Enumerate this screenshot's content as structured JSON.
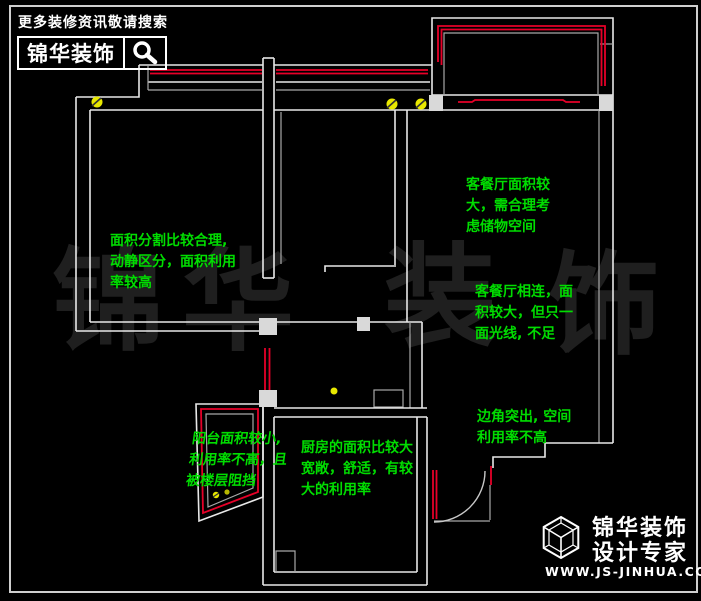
{
  "colors": {
    "background": "#000000",
    "wall_white": "#e8e8e8",
    "wall_gray": "#a8a8a8",
    "window_red": "#e60028",
    "annotation_green": "#00dd00",
    "symbol_yellow": "#e8e800",
    "watermark_gray": "#1f1f1f",
    "text_white": "#ffffff"
  },
  "header": {
    "slogan": "更多装修资讯敬请搜索",
    "brand": "锦华装饰"
  },
  "watermark": {
    "chars": [
      "锦",
      "华",
      "装",
      "饰"
    ]
  },
  "annotations": {
    "left_room": {
      "lines": [
        "面积分割比较合理,",
        "动静区分，面积利用",
        "率较高"
      ]
    },
    "living_top": {
      "lines": [
        "客餐厅面积较",
        "大，需合理考",
        "虑储物空间"
      ]
    },
    "living_mid": {
      "lines": [
        "客餐厅相连，面",
        "积较大，但只一",
        "面光线, 不足"
      ]
    },
    "corner": {
      "lines": [
        "边角突出, 空间",
        "利用率不高"
      ]
    },
    "balcony": {
      "lines": [
        "阳台面积较小,",
        "利用率不高，且",
        "被楼层阻挡"
      ]
    },
    "kitchen": {
      "lines": [
        "厨房的面积比较大",
        "宽敞，舒适，有较",
        "大的利用率"
      ]
    }
  },
  "footer": {
    "brand_line1": "锦华装饰",
    "brand_line2": "设计专家",
    "website": "WWW.JS-JINHUA.COM"
  }
}
